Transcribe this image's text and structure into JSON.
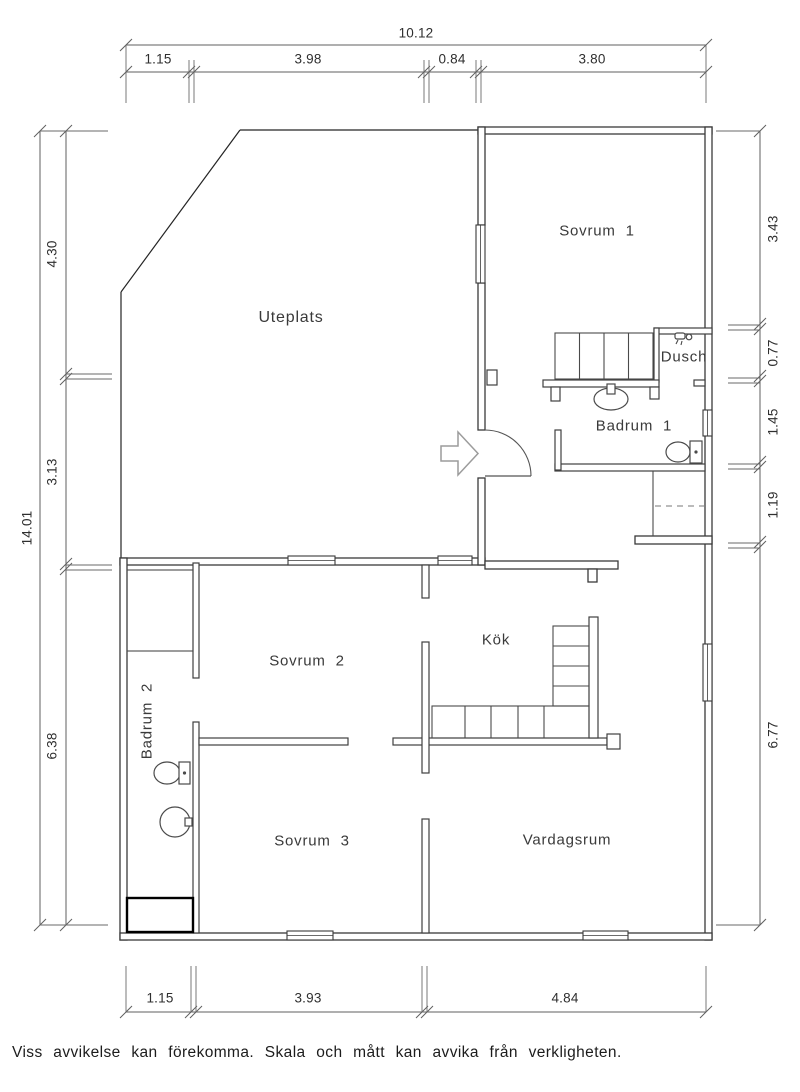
{
  "plan": {
    "rooms": {
      "uteplats": {
        "label": "Uteplats"
      },
      "sovrum1": {
        "label": "Sovrum  1"
      },
      "dusch": {
        "label": "Dusch"
      },
      "badrum1": {
        "label": "Badrum  1"
      },
      "sovrum2": {
        "label": "Sovrum  2"
      },
      "kok": {
        "label": "Kök"
      },
      "badrum2": {
        "label": "Badrum  2"
      },
      "sovrum3": {
        "label": "Sovrum  3"
      },
      "vardagsrum": {
        "label": "Vardagsrum"
      }
    },
    "dimensions": {
      "top": {
        "overall": "10.12",
        "segments": [
          "1.15",
          "3.98",
          "0.84",
          "3.80"
        ]
      },
      "bottom": {
        "segments": [
          "1.15",
          "3.93",
          "4.84"
        ]
      },
      "left": {
        "overall": "14.01",
        "segments": [
          "4.30",
          "3.13",
          "6.38"
        ]
      },
      "right": {
        "segments": [
          "3.43",
          "0.77",
          "1.45",
          "1.19",
          "6.77"
        ]
      }
    },
    "footer": {
      "disclaimer": "Viss avvikelse kan förekomma. Skala och mått kan avvika från verkligheten."
    },
    "icons": {
      "entrance_arrow": "entrance-arrow-icon",
      "door_swing": "door-swing-icon",
      "toilet": "toilet-icon",
      "sink": "sink-icon",
      "shower_head": "shower-head-icon",
      "shower_base": "shower-base-icon",
      "window": "window-symbol",
      "stairs": "staircase",
      "wardrobe": "wardrobe"
    },
    "colors": {
      "background": "#ffffff",
      "wall_line": "#3a3a3a",
      "dimension_line": "#5f5f5f",
      "text": "#3a3a3a",
      "arrow_gray": "#9c9c9c"
    }
  }
}
